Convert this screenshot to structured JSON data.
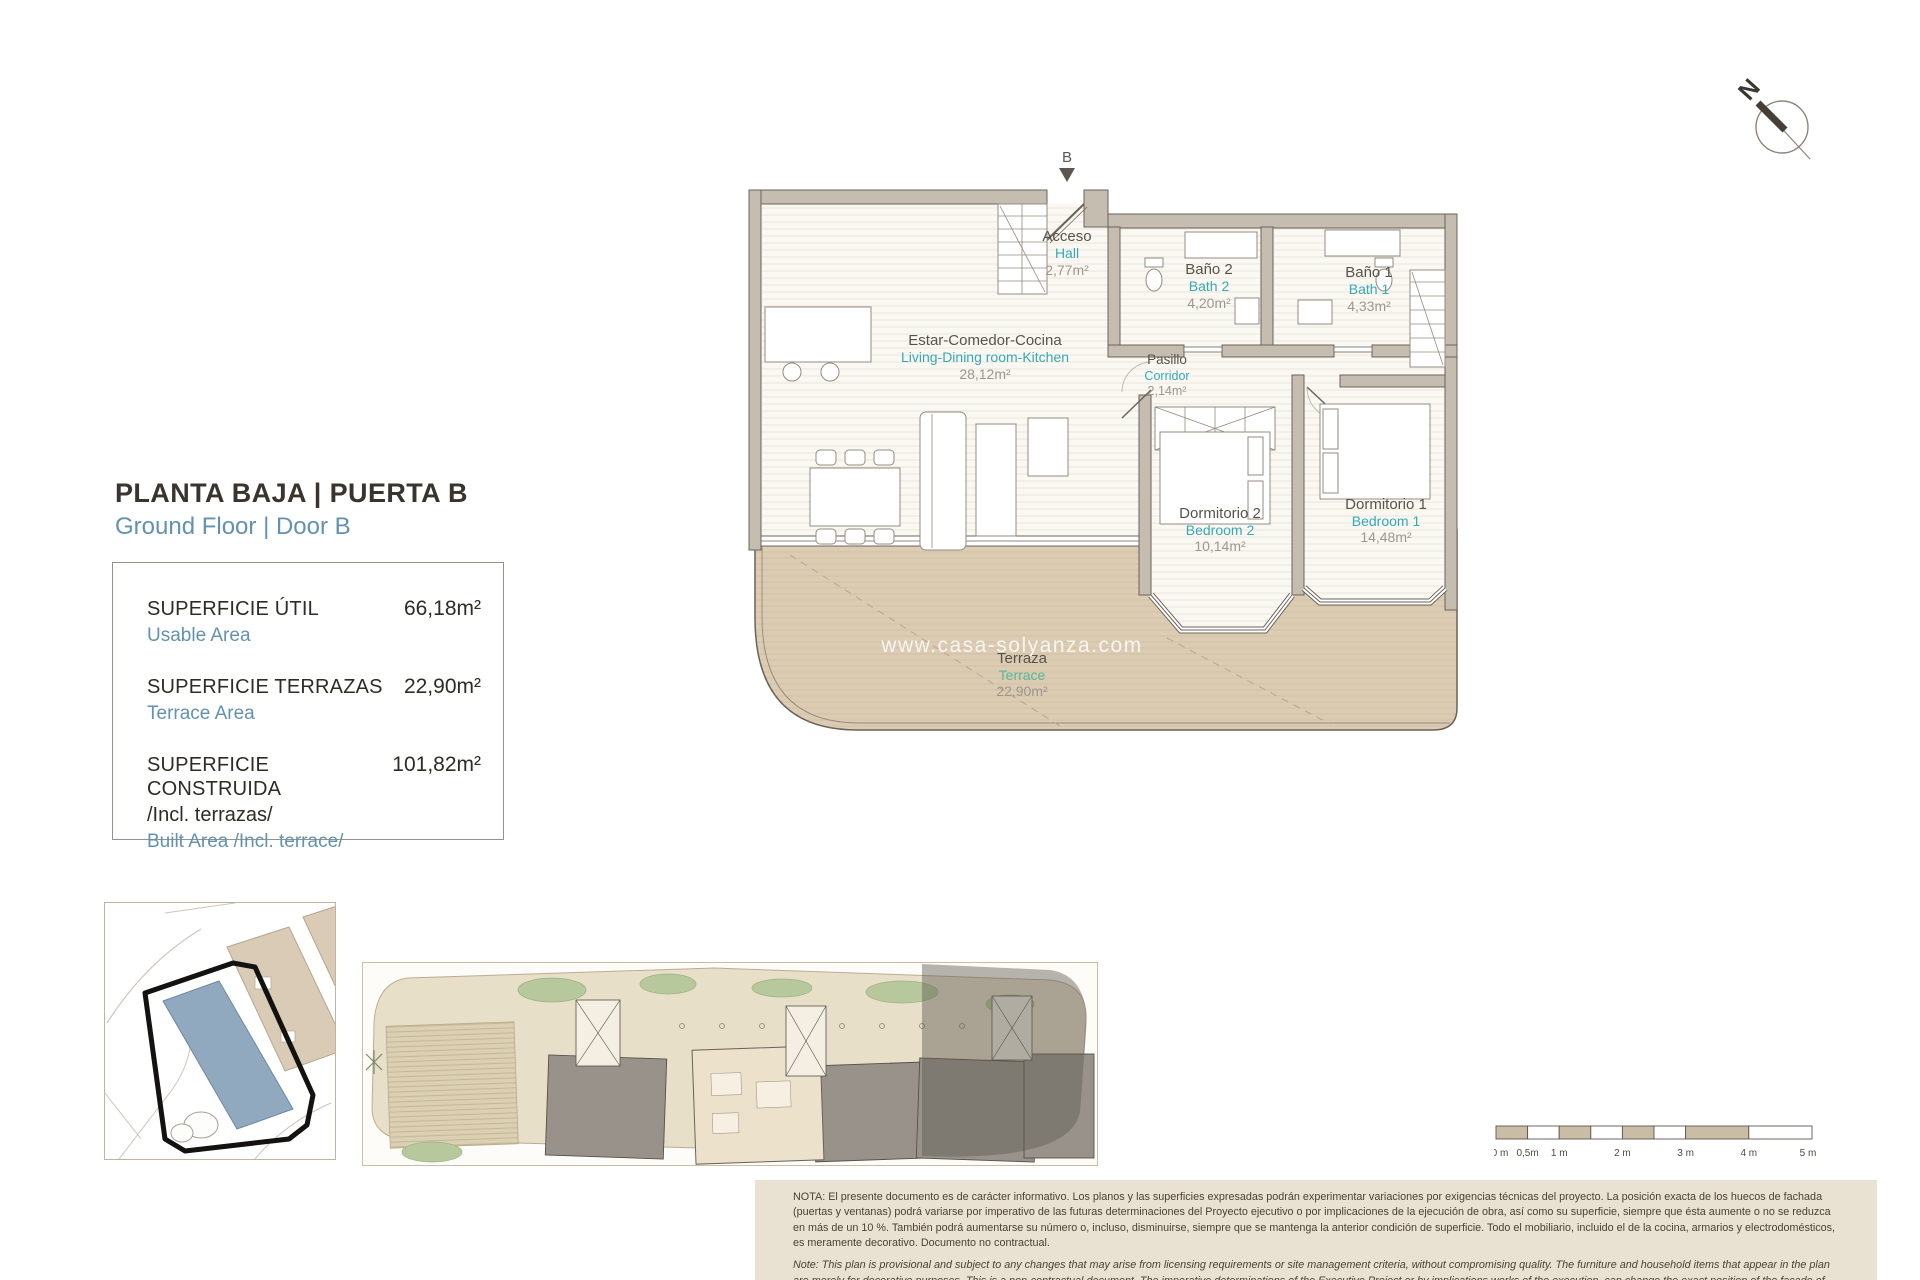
{
  "header": {
    "title_es": "PLANTA BAJA | PUERTA B",
    "title_en": "Ground Floor | Door B"
  },
  "compass": {
    "label": "N"
  },
  "plan": {
    "entrance_label": "B",
    "watermark": "www.casa-solyanza.com",
    "rooms": [
      {
        "es": "Acceso",
        "en": "Hall",
        "area": "2,77m²"
      },
      {
        "es": "Estar-Comedor-Cocina",
        "en": "Living-Dining room-Kitchen",
        "area": "28,12m²"
      },
      {
        "es": "Baño 2",
        "en": "Bath 2",
        "area": "4,20m²"
      },
      {
        "es": "Baño 1",
        "en": "Bath 1",
        "area": "4,33m²"
      },
      {
        "es": "Pasillo",
        "en": "Corridor",
        "area": "2,14m²"
      },
      {
        "es": "Dormitorio 2",
        "en": "Bedroom 2",
        "area": "10,14m²"
      },
      {
        "es": "Dormitorio 1",
        "en": "Bedroom 1",
        "area": "14,48m²"
      },
      {
        "es": "Terraza",
        "en": "Terrace",
        "area": "22,90m²"
      }
    ]
  },
  "areas": {
    "rows": [
      {
        "label_es": "SUPERFICIE ÚTIL",
        "label_es2": "",
        "label_en": "Usable Area",
        "value": "66,18m²"
      },
      {
        "label_es": "SUPERFICIE TERRAZAS",
        "label_es2": "",
        "label_en": "Terrace Area",
        "value": "22,90m²"
      },
      {
        "label_es": "SUPERFICIE CONSTRUIDA",
        "label_es2": "/Incl. terrazas/",
        "label_en": "Built Area /Incl. terrace/",
        "value": "101,82m²"
      }
    ]
  },
  "scalebar": {
    "labels": [
      "0 m",
      "0,5m",
      "1 m",
      "2 m",
      "3 m",
      "4 m",
      "5 m"
    ]
  },
  "notes": {
    "es": "NOTA: El presente documento es de carácter informativo. Los planos y las superficies expresadas podrán experimentar variaciones por exigencias técnicas del proyecto. La posición exacta de los huecos de fachada (puertas y ventanas) podrá variarse por imperativo de las futuras determinaciones del Proyecto ejecutivo o por implicaciones de la ejecución de obra, así como su superficie, siempre que ésta aumente o no se reduzca en más de un 10 %. También podrá aumentarse su número o, incluso, disminuirse, siempre que se mantenga la anterior condición de superficie. Todo el mobiliario, incluido el de la cocina, armarios y electrodomésticos, es meramente decorativo. Documento no contractual.",
    "en": "Note: This plan is provisional and subject to any changes that may arise from licensing requirements or site management criteria, without compromising quality. The furniture and household items that appear in the plan are merely for decorative purposes. This is a non-contractual document. The imperative determinations of the Executive Project or by implications works of the execution, can change the exact position of the facade of doors and windows, as well the surface area may also be increased or even decrease not more than a 10%.",
    "version": "V.1_JUN-25"
  },
  "colors": {
    "accent_teal": "#35A9B6",
    "accent_blue": "#6292B0",
    "terrace_green": "#54B79D",
    "wall": "#C6BDB1",
    "terrace_fill": "#DCCDB4",
    "note_bg": "#E9E1D2"
  }
}
